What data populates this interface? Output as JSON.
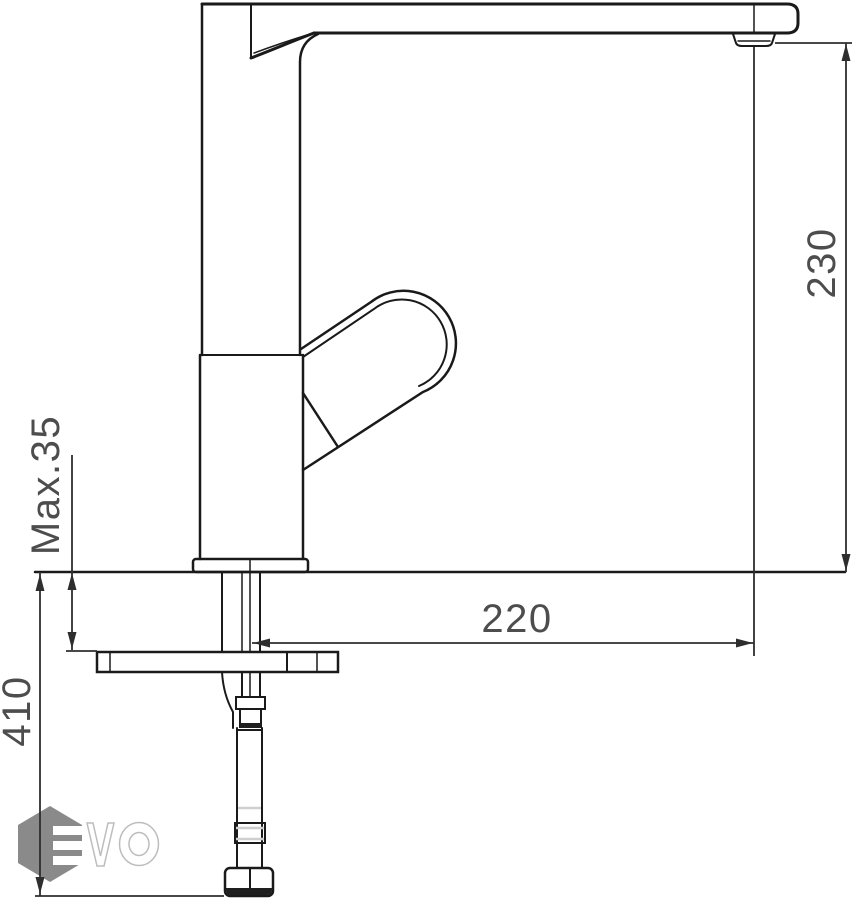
{
  "drawing": {
    "title": "single-lever kitchen faucet installation drawing",
    "dimensions": {
      "spout_height": {
        "label": "230",
        "orientation": "vertical",
        "measures": "aerator to counter top"
      },
      "spout_reach": {
        "label": "220",
        "orientation": "horizontal",
        "measures": "faucet axis to aerator axis"
      },
      "counter_thickness": {
        "label": "Max.35",
        "orientation": "vertical",
        "measures": "maximum mounting deck thickness"
      },
      "hose_length": {
        "label": "410",
        "orientation": "vertical",
        "measures": "counter top to hose end"
      }
    },
    "logo": {
      "letters": "VO",
      "mark": "hexagon-with-E-bars"
    },
    "colors": {
      "line": "#1a1a1a",
      "dim": "#2e2e2e",
      "dim_text": "#4d4d4d",
      "logo_gray": "#8a8a8a",
      "logo_outline": "#bdbdbd",
      "background": "#ffffff"
    }
  }
}
